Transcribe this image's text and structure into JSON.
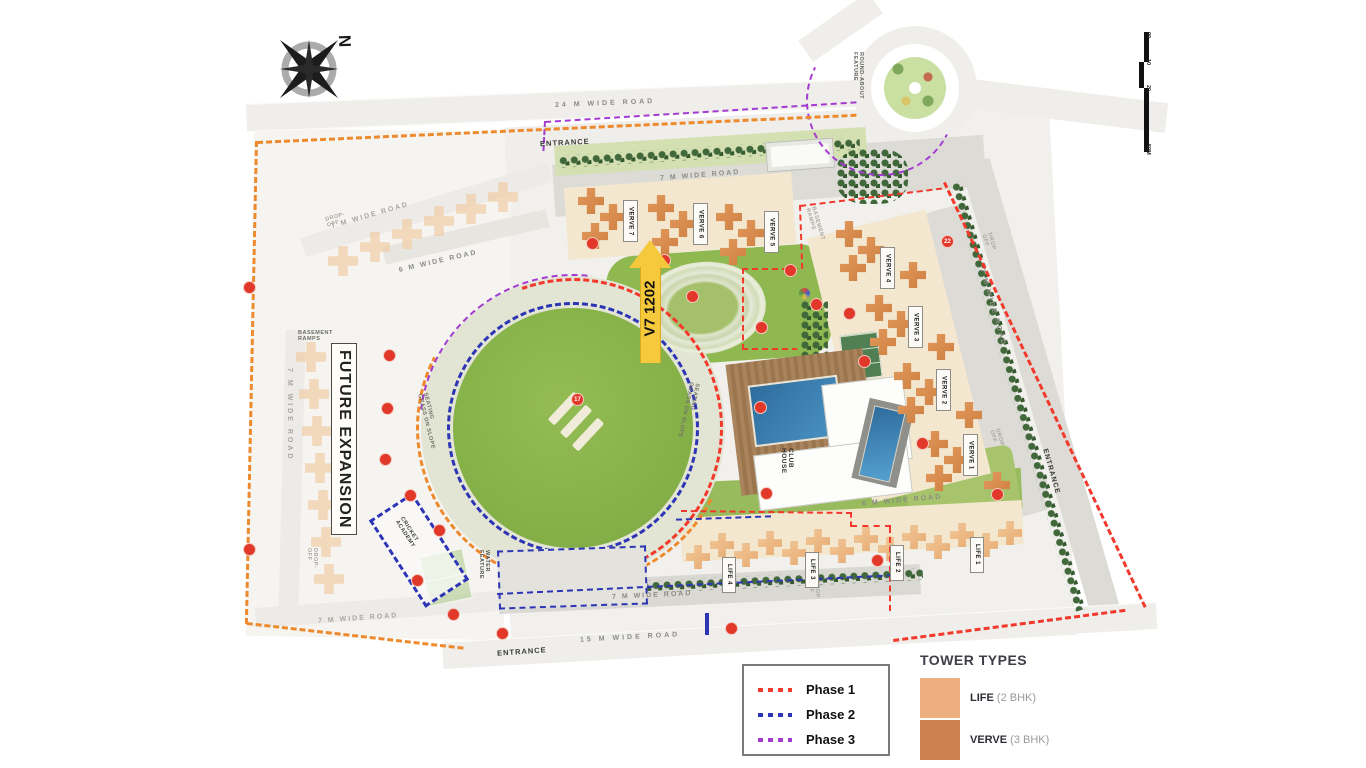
{
  "compass": {
    "north": "N"
  },
  "scale": {
    "t0": "00",
    "t1": "10",
    "t2": "20",
    "t3": "50M"
  },
  "roads": {
    "top": "24 M WIDE ROAD",
    "inner_top": "7 M WIDE ROAD",
    "left_diag": "7 M WIDE ROAD",
    "left_vert": "7 M WIDE ROAD",
    "left_bottom": "7 M WIDE ROAD",
    "mid_left": "6 M WIDE ROAD",
    "right_diag": "7 M WIDE ROAD",
    "mid_right": "6 M WIDE ROAD",
    "bottom_inner": "7 M WIDE ROAD",
    "bottom_main": "15 M WIDE ROAD"
  },
  "entrances": {
    "top": "ENTRANCE",
    "bottom": "ENTRANCE",
    "right": "ENTRANCE"
  },
  "areas": {
    "future_expansion": "FUTURE EXPANSION",
    "basement_ramps": "BASEMENT\nRAMPS",
    "round_about": "ROUND-ABOUT\nFEATURE",
    "cricket_academy": "CRICKET\nACADEMY",
    "water_feature": "WATER\nFEATURE",
    "seating": "SEATING\nGRASS ON SLOPE",
    "club_house": "CLUB\nHOUSE",
    "drop_off": "DROP-\nOFF",
    "drop_off2": "DROP\nOFF"
  },
  "highlight": {
    "unit": "V7 1202"
  },
  "towers": {
    "verve": [
      "VERVE 7",
      "VERVE 6",
      "VERVE 5",
      "VERVE 4",
      "VERVE 3",
      "VERVE 2",
      "VERVE 1"
    ],
    "life": [
      "LIFE 4",
      "LIFE 3",
      "LIFE 2",
      "LIFE 1"
    ]
  },
  "markers": {
    "pitch": "17",
    "right_road": "22"
  },
  "legend": {
    "phases": [
      {
        "label": "Phase 1",
        "color": "#F2392C"
      },
      {
        "label": "Phase 2",
        "color": "#2D35B5"
      },
      {
        "label": "Phase 3",
        "color": "#A43BD0"
      }
    ],
    "tower_types": {
      "title": "TOWER TYPES",
      "entries": [
        {
          "name": "LIFE",
          "desc": "(2 BHK)",
          "color": "#EDAF80"
        },
        {
          "name": "VERVE",
          "desc": "(3 BHK)",
          "color": "#CE814E"
        }
      ]
    }
  },
  "phase_colors": {
    "phase1": "#F2392C",
    "phase2": "#2D35B5",
    "phase3": "#A43BD0",
    "future_boundary": "#EE8A2E",
    "highlight_arrow": "#F6C83B"
  }
}
